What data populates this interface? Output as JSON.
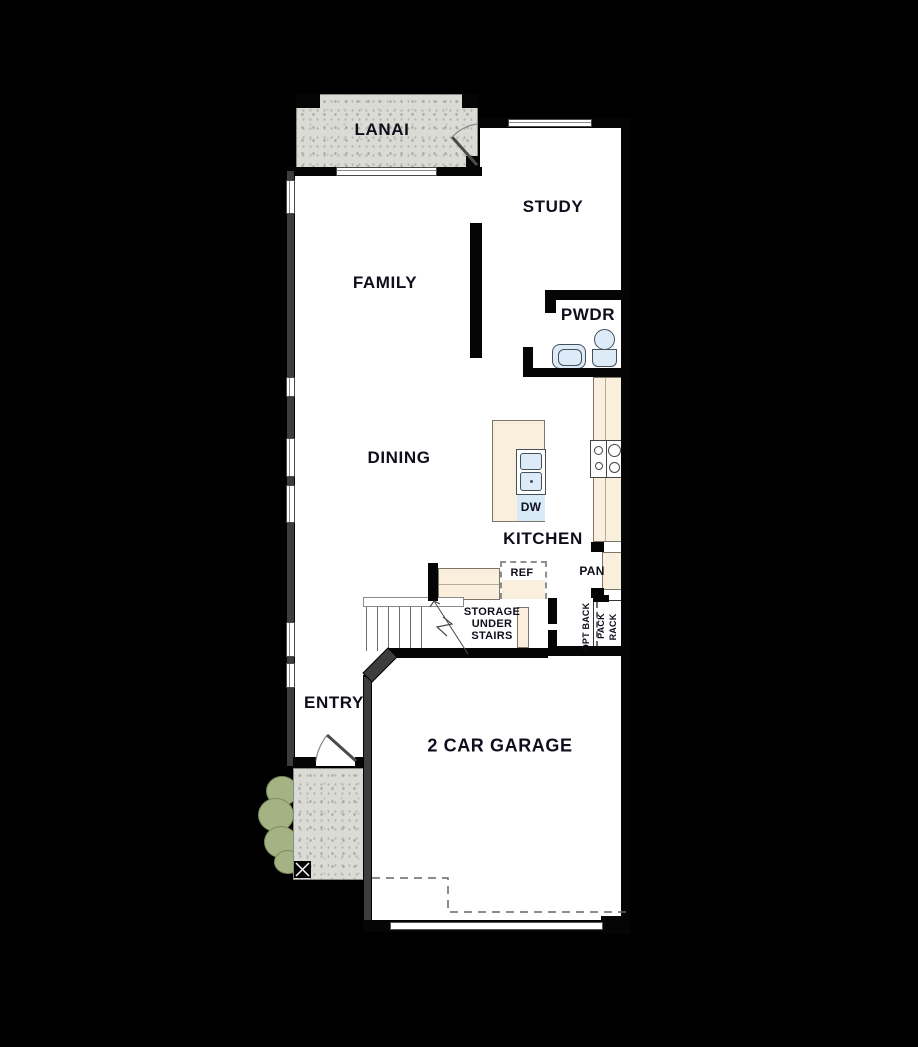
{
  "plan": {
    "labels": {
      "lanai": "LANAI",
      "study": "STUDY",
      "family": "FAMILY",
      "pwdr": "PWDR",
      "dining": "DINING",
      "kitchen": "KITCHEN",
      "entry": "ENTRY",
      "garage": "2 CAR GARAGE",
      "dishwasher": "DW",
      "refrigerator": "REF",
      "pantry": "PAN",
      "storage_under_stairs": [
        "STORAGE",
        "UNDER",
        "STAIRS"
      ],
      "opt_back_pack_rack": [
        "OPT BACK",
        "PACK",
        "RACK"
      ]
    },
    "colors": {
      "background": "#000000",
      "floor": "#ffffff",
      "wall": "#050505",
      "counter_tan": "#faeedd",
      "fixture_blue": "#dcebf7",
      "patio_gray": "#dbdbd6",
      "shrub_green": "#a5b284",
      "label_text": "#0e0e1c"
    }
  }
}
